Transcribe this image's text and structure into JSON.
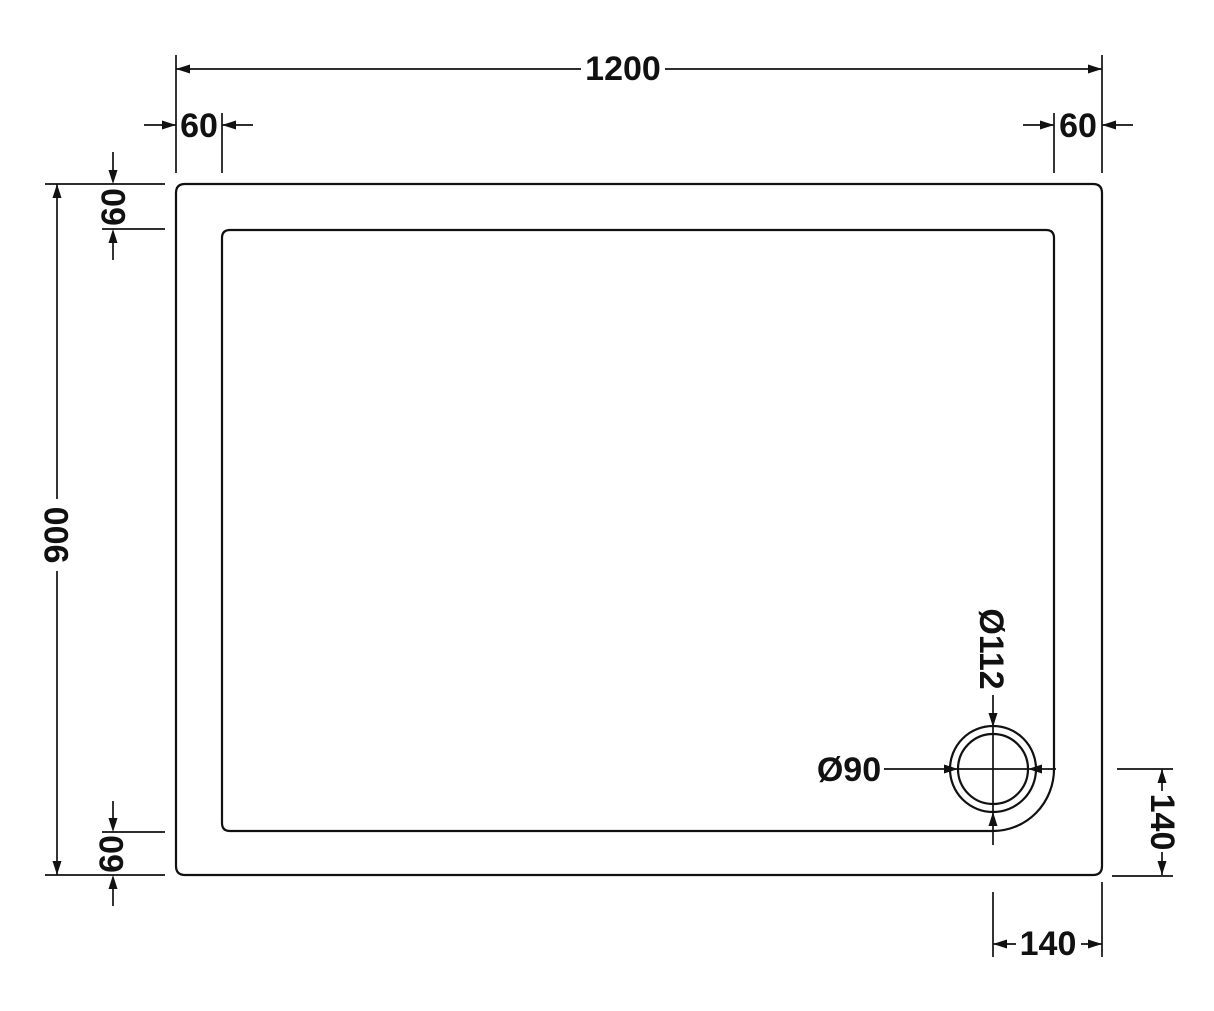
{
  "drawing": {
    "background": "#ffffff",
    "line_color": "#111111",
    "labels": {
      "total_width": "1200",
      "top_left_offset": "60",
      "top_right_offset": "60",
      "total_height": "900",
      "left_top_offset": "60",
      "left_bottom_offset": "60",
      "waste_outer_diameter": "Ø112",
      "waste_diameter": "Ø90",
      "waste_right_offset": "140",
      "waste_bottom_offset": "140"
    }
  }
}
